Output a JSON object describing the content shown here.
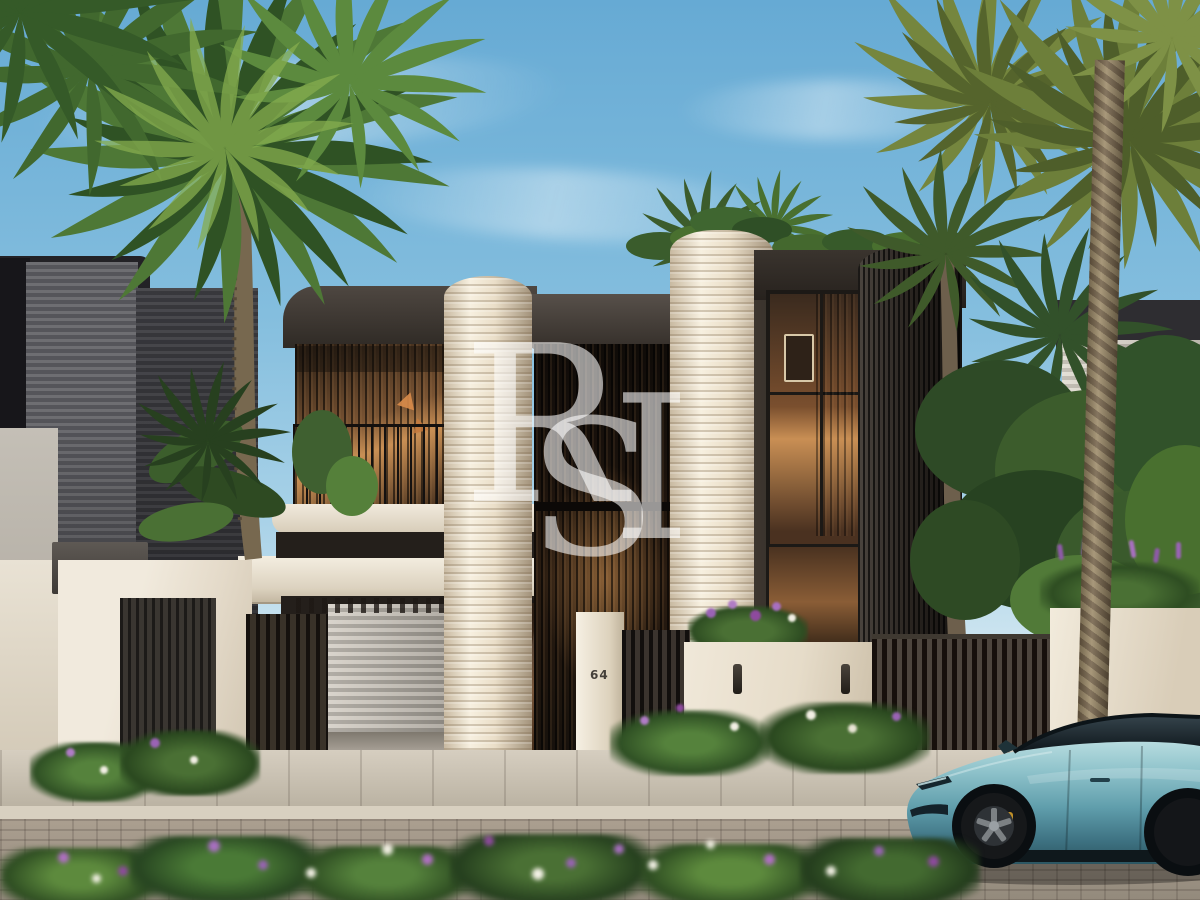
{
  "watermark": {
    "letter_1": "R",
    "letter_2": "S",
    "letter_3": "I"
  },
  "house": {
    "number": "64"
  },
  "palette": {
    "sky_top": "#66aad4",
    "sky_horizon": "#e9f2f2",
    "foliage_dark": "#2e4a24",
    "foliage_mid": "#4d7434",
    "foliage_light": "#7da548",
    "palm_olive": "#75863e",
    "trunk_tan": "#9c8a68",
    "facade_charcoal": "#352f2a",
    "facade_black": "#1b1816",
    "ribbed_cream": "#ece2cf",
    "wall_cream": "#e9e0d0",
    "interior_glow": "#c98f54",
    "pavement": "#c2bab0",
    "road_brick": "#a59c8e",
    "car_teal": "#6fa9b5",
    "car_shadow": "#2c5662",
    "flower_purple": "#9a63b5",
    "flower_white": "#f2efe4"
  }
}
